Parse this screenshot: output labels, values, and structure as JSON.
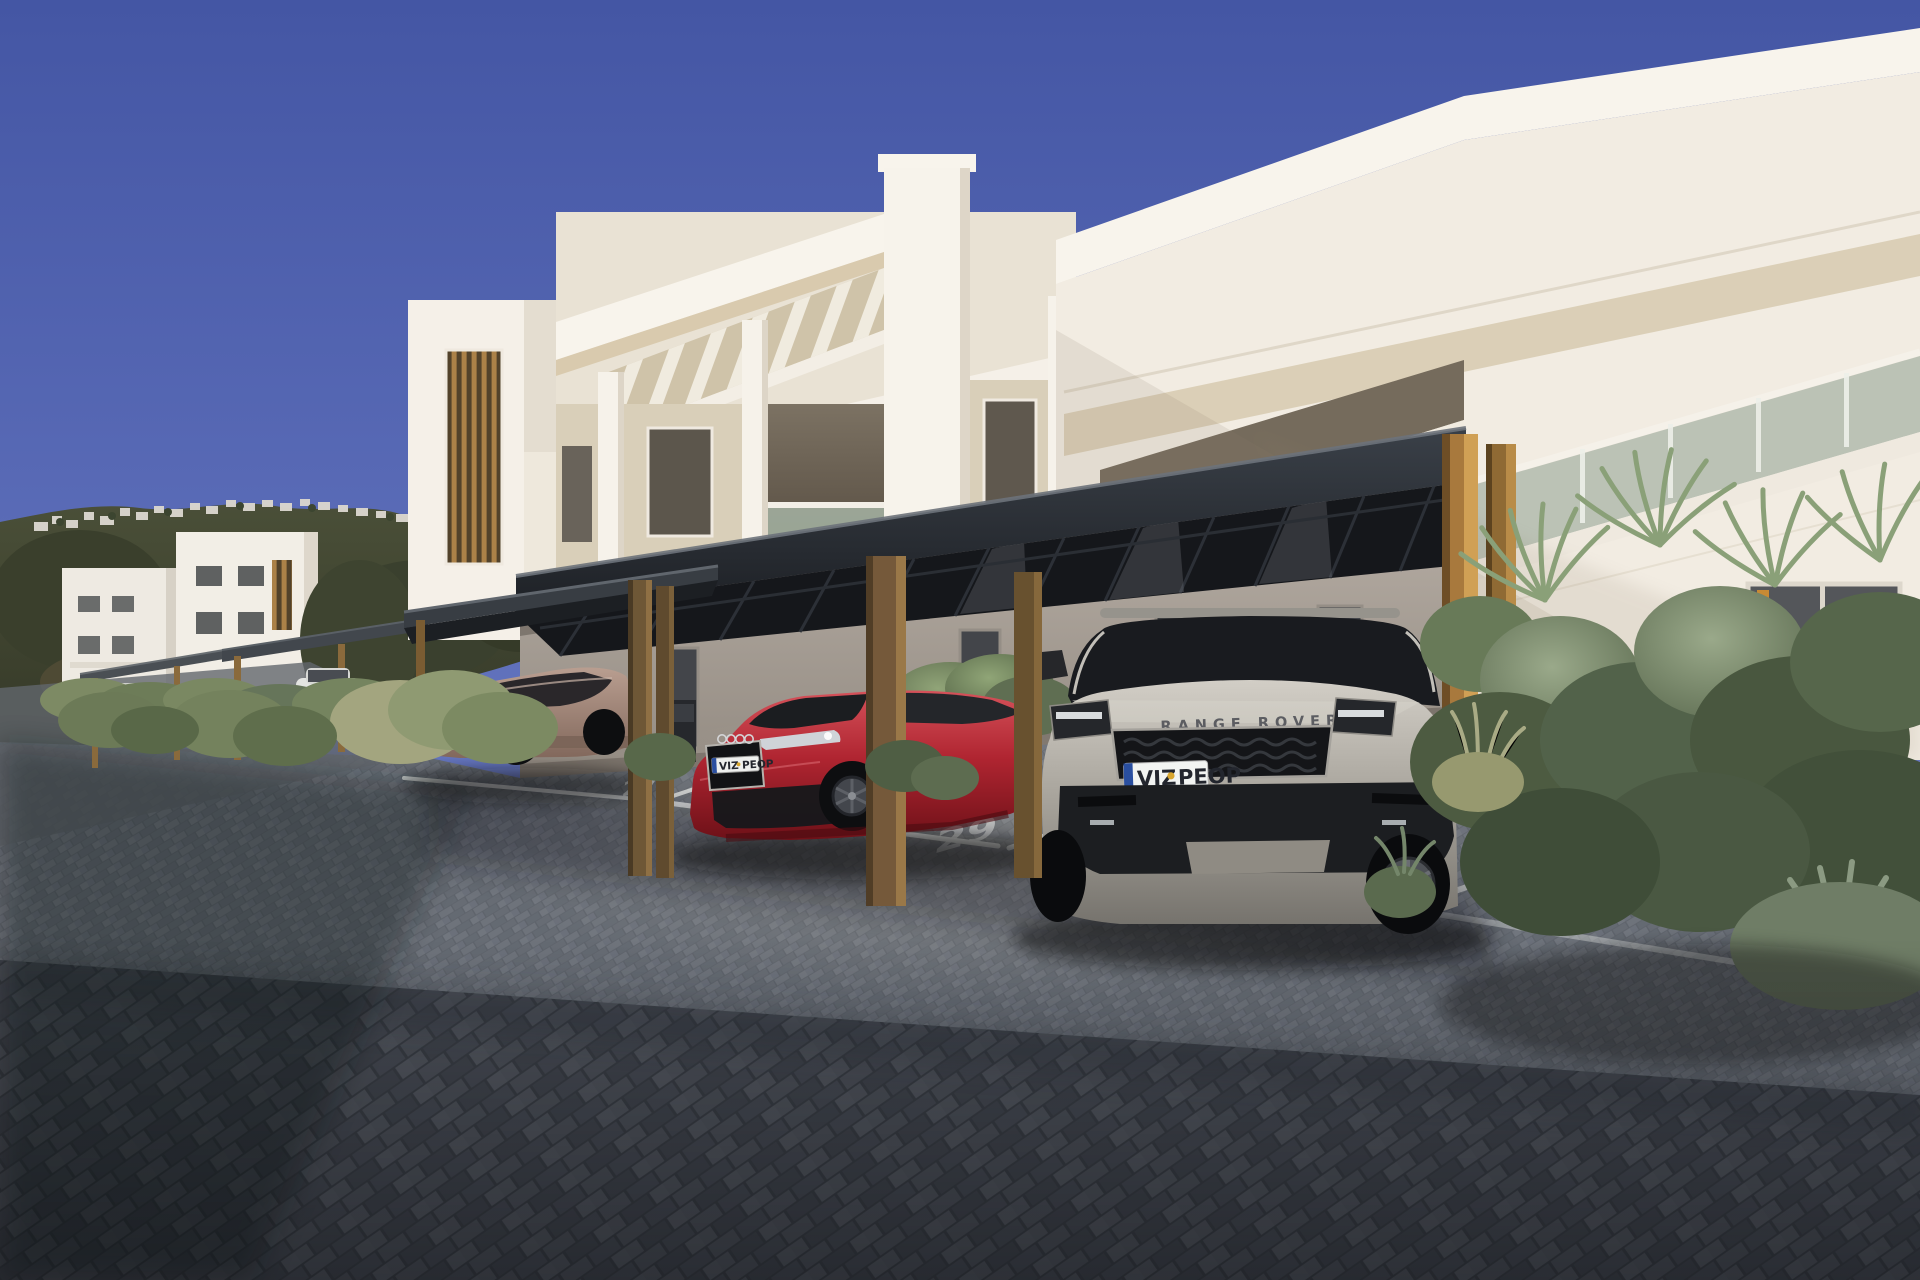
{
  "scene": {
    "type": "exterior-architectural-render",
    "description": "Sunny 3D rendering of a modern white apartment complex with dark flat carport canopies on wooden posts, numbered parking bays on grey herringbone pavers, three parked cars and lush planting; hillside village in the distance.",
    "sky": {
      "top": "#4456a4",
      "horizon": "#8a97d0"
    }
  },
  "building": {
    "wall_white": "#f6f1e8",
    "wall_cream": "#d9cfb9",
    "fascia_underside": "#d9caae",
    "shaded_ground_wall": "#a89f96",
    "glass_balustrade": "#b6beb1"
  },
  "carport": {
    "canopy_color": "#23262b",
    "post_color": "#a8793d",
    "post_pairs": 3
  },
  "parking": {
    "space_numbers": [
      "27",
      "28",
      "29",
      "30"
    ],
    "marking_color": "#dfe1de",
    "surface": "grey herringbone pavers"
  },
  "vehicles": {
    "bronze_hatchback": {
      "body_color": "#9b7e72",
      "view": "rear-three-quarter"
    },
    "red_coupe": {
      "body_color": "#b01f2e",
      "view": "front-three-quarter",
      "plate": {
        "left": "VIZ",
        "right": "PEOP"
      }
    },
    "silver_suv": {
      "body_color": "#a5a199",
      "view": "front",
      "hood_text": "RANGE ROVER",
      "plate": {
        "left": "VIZ",
        "right": "PEOP"
      }
    }
  },
  "landscape": {
    "hill_village_color": "#dad6ce",
    "tree_color": "#3f4430",
    "shrub_color": "#75866a"
  }
}
